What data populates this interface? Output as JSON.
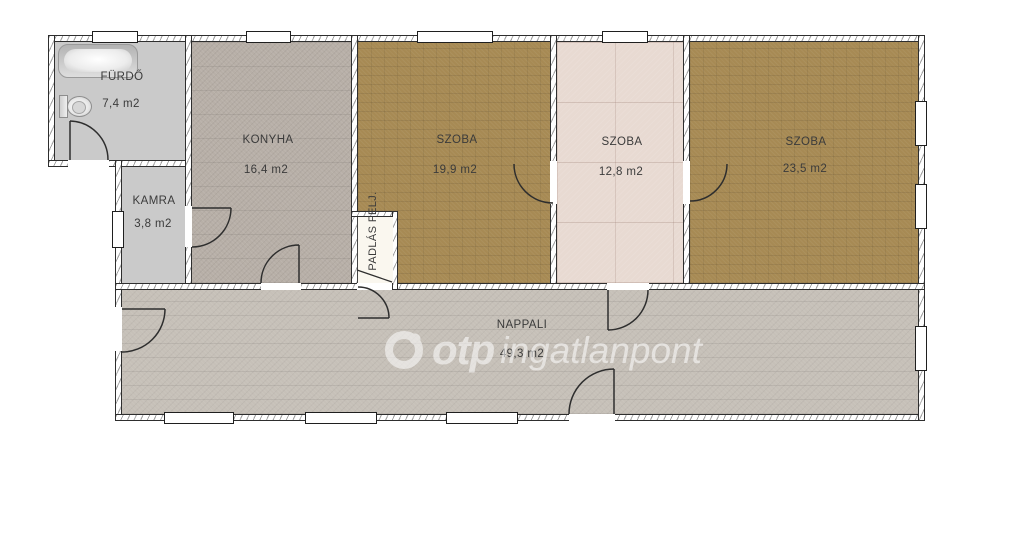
{
  "floorplan": {
    "rooms": {
      "furdo": {
        "name": "FÜRDŐ",
        "area": "7,4 m2"
      },
      "kamra": {
        "name": "KAMRA",
        "area": "3,8 m2"
      },
      "konyha": {
        "name": "KONYHA",
        "area": "16,4 m2"
      },
      "szoba1": {
        "name": "SZOBA",
        "area": "19,9 m2"
      },
      "szoba2": {
        "name": "SZOBA",
        "area": "12,8 m2"
      },
      "szoba3": {
        "name": "SZOBA",
        "area": "23,5 m2"
      },
      "nappali": {
        "name": "NAPPALI",
        "area": "49,3 m2"
      },
      "padlas": {
        "name": "PADLÁS FELJ."
      }
    },
    "watermark": {
      "brand": "otp",
      "name": "ingatlanpont"
    },
    "colors": {
      "room_brown": "#a78a54",
      "room_pink": "#e8dad2",
      "kitchen_taupe": "#b7afa7",
      "living_gray": "#c6c0b8",
      "wet_gray": "#cacaca",
      "wall_line": "#2e2e2e"
    }
  }
}
